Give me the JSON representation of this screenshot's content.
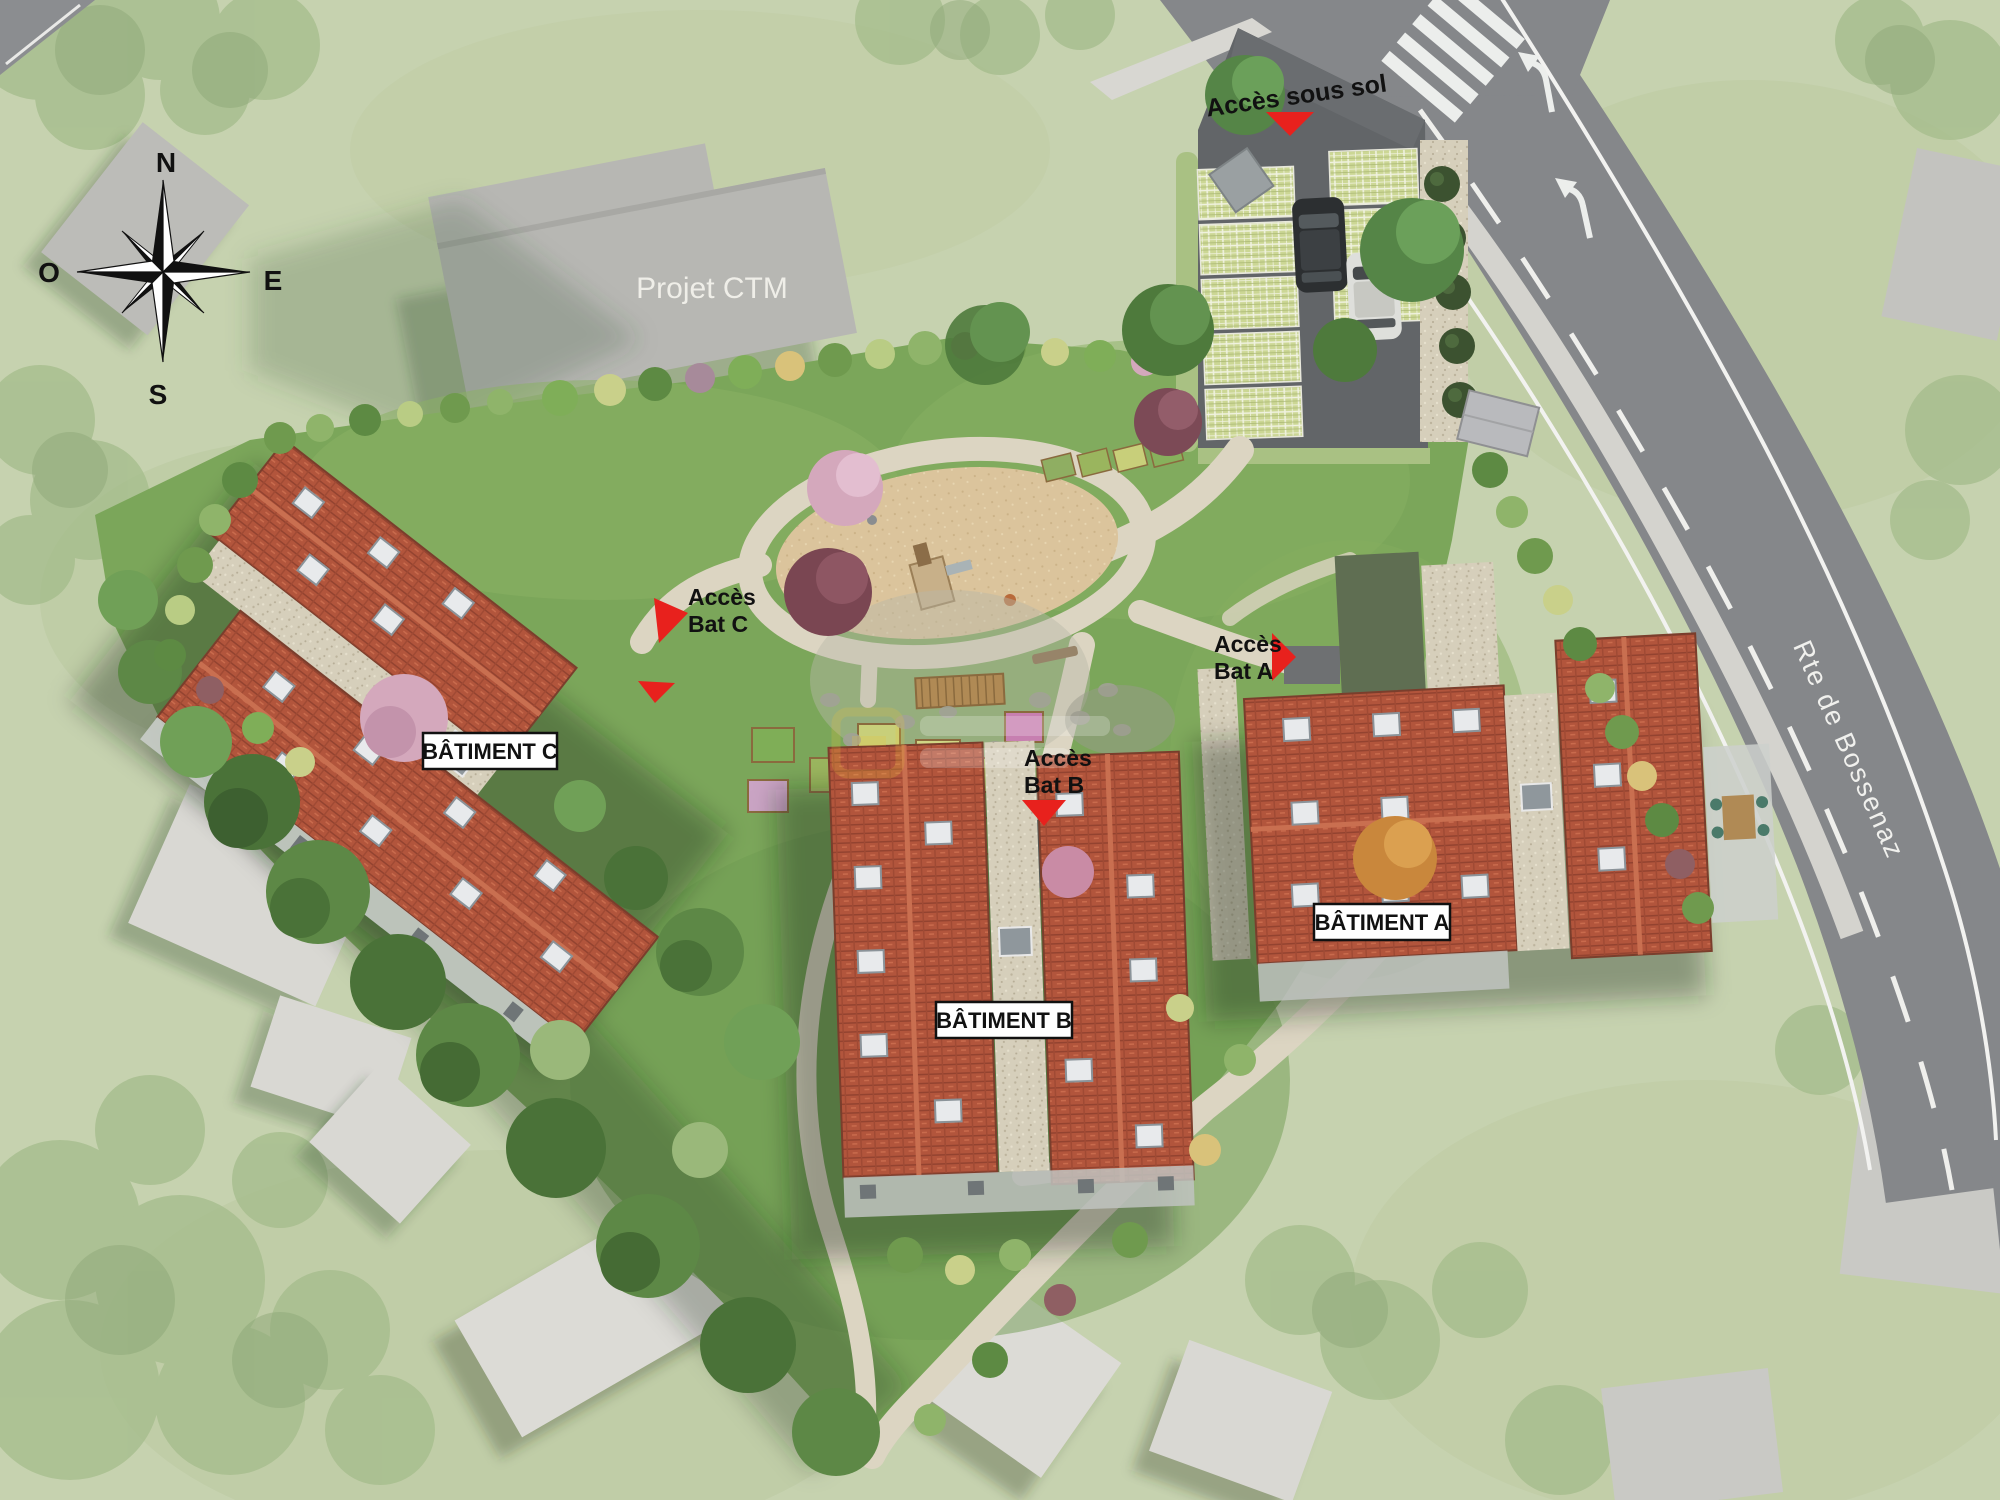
{
  "site_plan": {
    "compass": {
      "north": "N",
      "west": "O",
      "east": "E",
      "south": "S"
    },
    "neighbor_project_label": "Projet CTM",
    "road_label": "Rte de Bossenaz",
    "buildings": [
      {
        "id": "A",
        "label": "BÂTIMENT A"
      },
      {
        "id": "B",
        "label": "BÂTIMENT B"
      },
      {
        "id": "C",
        "label": "BÂTIMENT C"
      }
    ],
    "access": {
      "basement": "Accès sous sol",
      "bat_c": {
        "line1": "Accès",
        "line2": "Bat C"
      },
      "bat_b": {
        "line1": "Accès",
        "line2": "Bat B"
      },
      "bat_a": {
        "line1": "Accès",
        "line2": "Bat A"
      }
    },
    "colors": {
      "access_marker_red": "#e8211d",
      "roof_red": "#b2553c",
      "site_grass": "#7ba65a",
      "outer_grass": "#c6d2af",
      "road_gray": "#85878a",
      "label_box_bg": "#ffffff",
      "label_text": "#000000",
      "road_label_text": "#f0f0ed",
      "projet_ctm_text": "#efeee8"
    }
  }
}
